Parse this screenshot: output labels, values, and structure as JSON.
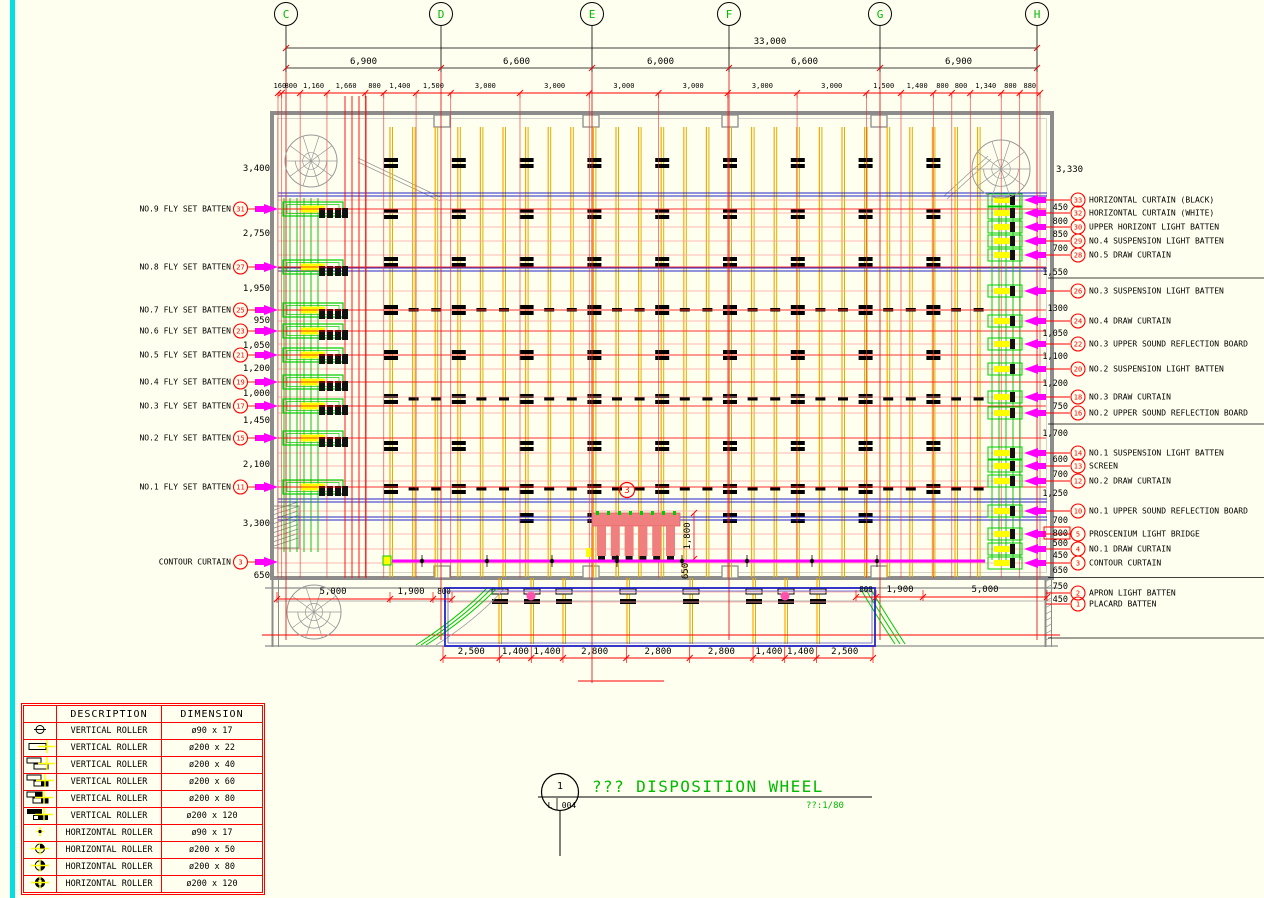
{
  "colors": {
    "background": "#FFFFEF",
    "dim_red": "#FF0000",
    "pink_line": "#FFA0A0",
    "strong_pink": "#FF3030",
    "cad_green": "#00BB00",
    "magenta": "#FF00FF",
    "blue": "#2424C8",
    "orange": "#FFA800",
    "gold": "#D9B300",
    "wall_gray": "#8C8C8C",
    "cyan": "#00E0E0",
    "yellow": "#FFFF00",
    "salmon": "#F08080",
    "black": "#000000"
  },
  "grid": {
    "labels": [
      "C",
      "D",
      "E",
      "F",
      "G",
      "H"
    ],
    "overall_dim": "33,000",
    "span_dims": [
      "6,900",
      "6,600",
      "6,000",
      "6,600",
      "6,900"
    ],
    "detail_dims": [
      "160",
      "800",
      "1,160",
      "1,660",
      "800",
      "1,400",
      "1,500",
      "3,000",
      "3,000",
      "3,000",
      "3,000",
      "3,000",
      "3,000",
      "1,500",
      "1,400",
      "800",
      "800",
      "1,340",
      "800",
      "880"
    ]
  },
  "left_side": {
    "labels": [
      {
        "num": "31",
        "text": "NO.9 FLY SET BATTEN"
      },
      {
        "num": "27",
        "text": "NO.8 FLY SET BATTEN"
      },
      {
        "num": "25",
        "text": "NO.7 FLY SET BATTEN"
      },
      {
        "num": "23",
        "text": "NO.6 FLY SET BATTEN"
      },
      {
        "num": "21",
        "text": "NO.5 FLY SET BATTEN"
      },
      {
        "num": "19",
        "text": "NO.4 FLY SET BATTEN"
      },
      {
        "num": "17",
        "text": "NO.3 FLY SET BATTEN"
      },
      {
        "num": "15",
        "text": "NO.2 FLY SET BATTEN"
      },
      {
        "num": "11",
        "text": "NO.1 FLY SET BATTEN"
      },
      {
        "num": "3",
        "text": "CONTOUR CURTAIN"
      }
    ],
    "dims": [
      "3,400",
      "2,750",
      "1,950",
      "950",
      "1,050",
      "1,200",
      "1,000",
      "1,450",
      "2,100",
      "3,300",
      "650"
    ]
  },
  "right_side": {
    "top_dim": "3,330",
    "labels": [
      {
        "num": "33",
        "text": "HORIZONTAL CURTAIN (BLACK)"
      },
      {
        "num": "32",
        "text": "HORIZONTAL CURTAIN (WHITE)"
      },
      {
        "num": "30",
        "text": "UPPER HORIZONT LIGHT BATTEN"
      },
      {
        "num": "29",
        "text": "NO.4 SUSPENSION LIGHT BATTEN"
      },
      {
        "num": "28",
        "text": "NO.5 DRAW CURTAIN"
      },
      {
        "num": "26",
        "text": "NO.3 SUSPENSION LIGHT BATTEN"
      },
      {
        "num": "24",
        "text": "NO.4 DRAW CURTAIN"
      },
      {
        "num": "22",
        "text": "NO.3 UPPER SOUND REFLECTION BOARD"
      },
      {
        "num": "20",
        "text": "NO.2 SUSPENSION LIGHT BATTEN"
      },
      {
        "num": "18",
        "text": "NO.3 DRAW CURTAIN"
      },
      {
        "num": "16",
        "text": "NO.2 UPPER SOUND REFLECTION BOARD"
      },
      {
        "num": "14",
        "text": "NO.1 SUSPENSION LIGHT BATTEN"
      },
      {
        "num": "13",
        "text": "SCREEN"
      },
      {
        "num": "12",
        "text": "NO.2 DRAW CURTAIN"
      },
      {
        "num": "10",
        "text": "NO.1 UPPER SOUND REFLECTION BOARD"
      },
      {
        "num": "5",
        "text": "PROSCENIUM LIGHT BRIDGE"
      },
      {
        "num": "4",
        "text": "NO.1 DRAW CURTAIN"
      },
      {
        "num": "3",
        "text": "CONTOUR CURTAIN"
      },
      {
        "num": "2",
        "text": "APRON LIGHT BATTEN"
      },
      {
        "num": "1",
        "text": "PLACARD BATTEN"
      }
    ],
    "dims": [
      "450",
      "800",
      "850",
      "700",
      "1,550",
      "1300",
      "1,050",
      "1,100",
      "1,200",
      "750",
      "1,700",
      "600",
      "700",
      "1,250",
      "700",
      "800",
      "500",
      "450",
      "650",
      "750",
      "450"
    ]
  },
  "bottom": {
    "outer_dims": [
      "2,500",
      "1,400",
      "1,400",
      "2,800",
      "2,800",
      "2,800",
      "1,400",
      "1,400",
      "2,500"
    ],
    "inner_left_dims": [
      "5,000",
      "1,900",
      "800"
    ],
    "inner_right_dims": [
      "800",
      "1,900",
      "5,000"
    ]
  },
  "center": {
    "callout_num": "3",
    "vertical_dims": [
      "1,800",
      "650"
    ]
  },
  "legend": {
    "col_headers": [
      "DESCRIPTION",
      "DIMENSION"
    ],
    "rows": [
      {
        "symbol": "vertical-roller-icon",
        "description": "VERTICAL ROLLER",
        "dimension": "ø90 x 17"
      },
      {
        "symbol": "vertical-roller-icon",
        "description": "VERTICAL ROLLER",
        "dimension": "ø200 x 22"
      },
      {
        "symbol": "vertical-roller-icon",
        "description": "VERTICAL ROLLER",
        "dimension": "ø200 x 40"
      },
      {
        "symbol": "vertical-roller-icon",
        "description": "VERTICAL ROLLER",
        "dimension": "ø200 x 60"
      },
      {
        "symbol": "vertical-roller-icon",
        "description": "VERTICAL ROLLER",
        "dimension": "ø200 x 80"
      },
      {
        "symbol": "vertical-roller-icon",
        "description": "VERTICAL ROLLER",
        "dimension": "ø200 x 120"
      },
      {
        "symbol": "horizontal-roller-icon",
        "description": "HORIZONTAL ROLLER",
        "dimension": "ø90 x 17"
      },
      {
        "symbol": "horizontal-roller-icon",
        "description": "HORIZONTAL ROLLER",
        "dimension": "ø200 x 50"
      },
      {
        "symbol": "horizontal-roller-icon",
        "description": "HORIZONTAL ROLLER",
        "dimension": "ø200 x 80"
      },
      {
        "symbol": "horizontal-roller-icon",
        "description": "HORIZONTAL ROLLER",
        "dimension": "ø200 x 120"
      }
    ]
  },
  "title_block": {
    "title": "??? DISPOSITION WHEEL",
    "scale": "??:1/80",
    "bubble_top": "1",
    "bubble_left": "L",
    "bubble_right": "004"
  }
}
